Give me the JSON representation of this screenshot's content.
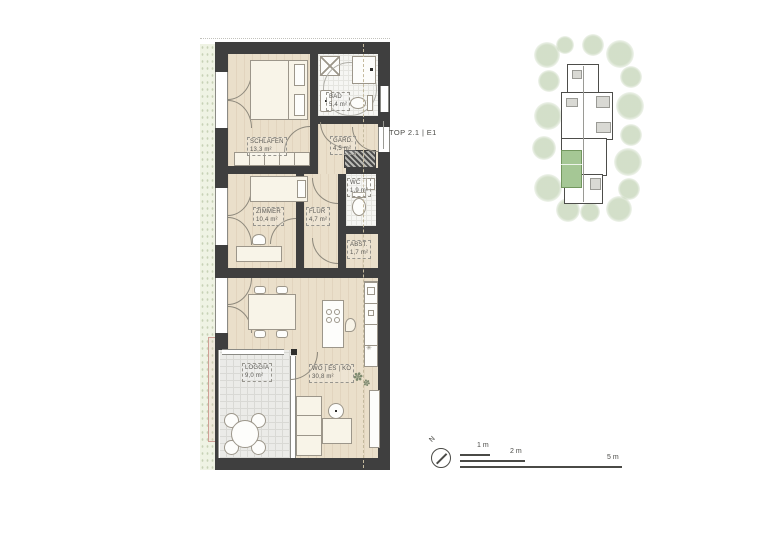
{
  "plan_label": {
    "text": "TOP 2.1 | E1"
  },
  "rooms": {
    "schlafen": {
      "name": "SCHLAFEN",
      "area": "13,3 m²"
    },
    "bad": {
      "name": "BAD",
      "area": "5,4 m²"
    },
    "gard": {
      "name": "GARD.",
      "area": "4,5 m²"
    },
    "zimmer": {
      "name": "ZIMMER",
      "area": "10,4 m²"
    },
    "flur": {
      "name": "FLUR",
      "area": "4,7 m²"
    },
    "wc": {
      "name": "WC",
      "area": "1,9 m²"
    },
    "abst": {
      "name": "ABST.",
      "area": "1,7 m²"
    },
    "loggia": {
      "name": "LOGGIA",
      "area": "9,0 m²"
    },
    "wohnen": {
      "name": "WO | ES | KO",
      "area": "30,8 m²"
    }
  },
  "compass": {
    "north_label": "N"
  },
  "scale_bar": {
    "marks": [
      {
        "label": "1 m"
      },
      {
        "label": "2 m"
      },
      {
        "label": "5 m"
      }
    ]
  },
  "colors": {
    "wall": "#3f3f3f",
    "wood_floor": "#eadfca",
    "tile_floor": "#f6f6f3",
    "loggia_floor": "#ebebe8",
    "garden_strip": "#eff3e4",
    "unit_highlight": "#a5c795",
    "tree_green": "#a7bf94",
    "planter_accent": "#cf9f96",
    "line": "#8d887c",
    "text": "#55544f"
  }
}
